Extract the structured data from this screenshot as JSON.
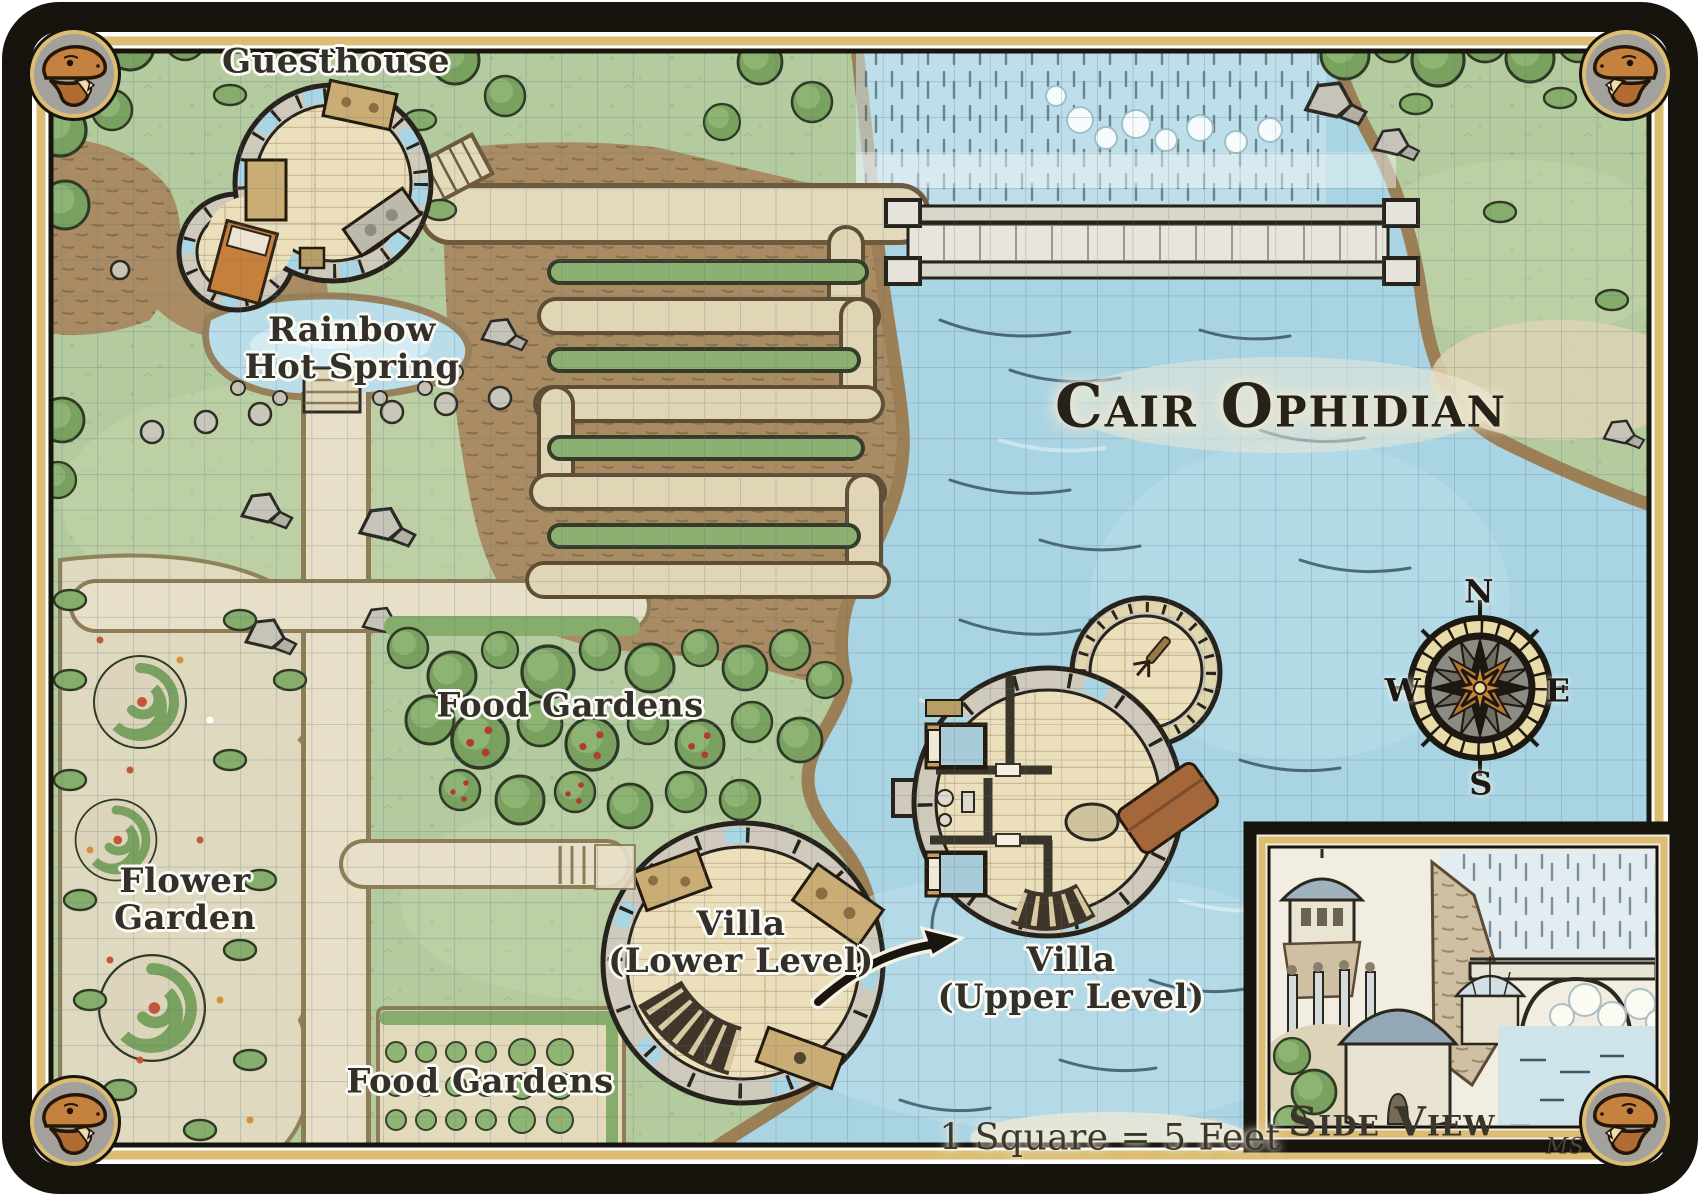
{
  "title": "Cair Ophidian",
  "scale_label": "1 Square = 5 Feet",
  "labels": {
    "guesthouse": "Guesthouse",
    "hot_spring_1": "Rainbow",
    "hot_spring_2": "Hot Spring",
    "food_gardens_upper": "Food Gardens",
    "flower_garden_1": "Flower",
    "flower_garden_2": "Garden",
    "villa_lower_1": "Villa",
    "villa_lower_2": "(Lower Level)",
    "villa_upper_1": "Villa",
    "villa_upper_2": "(Upper Level)",
    "food_gardens_lower": "Food Gardens"
  },
  "compass": {
    "n": "N",
    "e": "E",
    "s": "S",
    "w": "W"
  },
  "inset": {
    "title": "Side View",
    "signature": "MS"
  },
  "colors": {
    "water": "#a9d4e3",
    "grass": "#b4ca9f",
    "cliff": "#a98c63",
    "path": "#e6dec6",
    "frame_black": "#17130d",
    "frame_gold": "#dcbd72",
    "ink": "#2b281f",
    "snake": "#c5823f",
    "building_wall": "#cfcabb",
    "wood_floor": "#ecdfbc"
  }
}
